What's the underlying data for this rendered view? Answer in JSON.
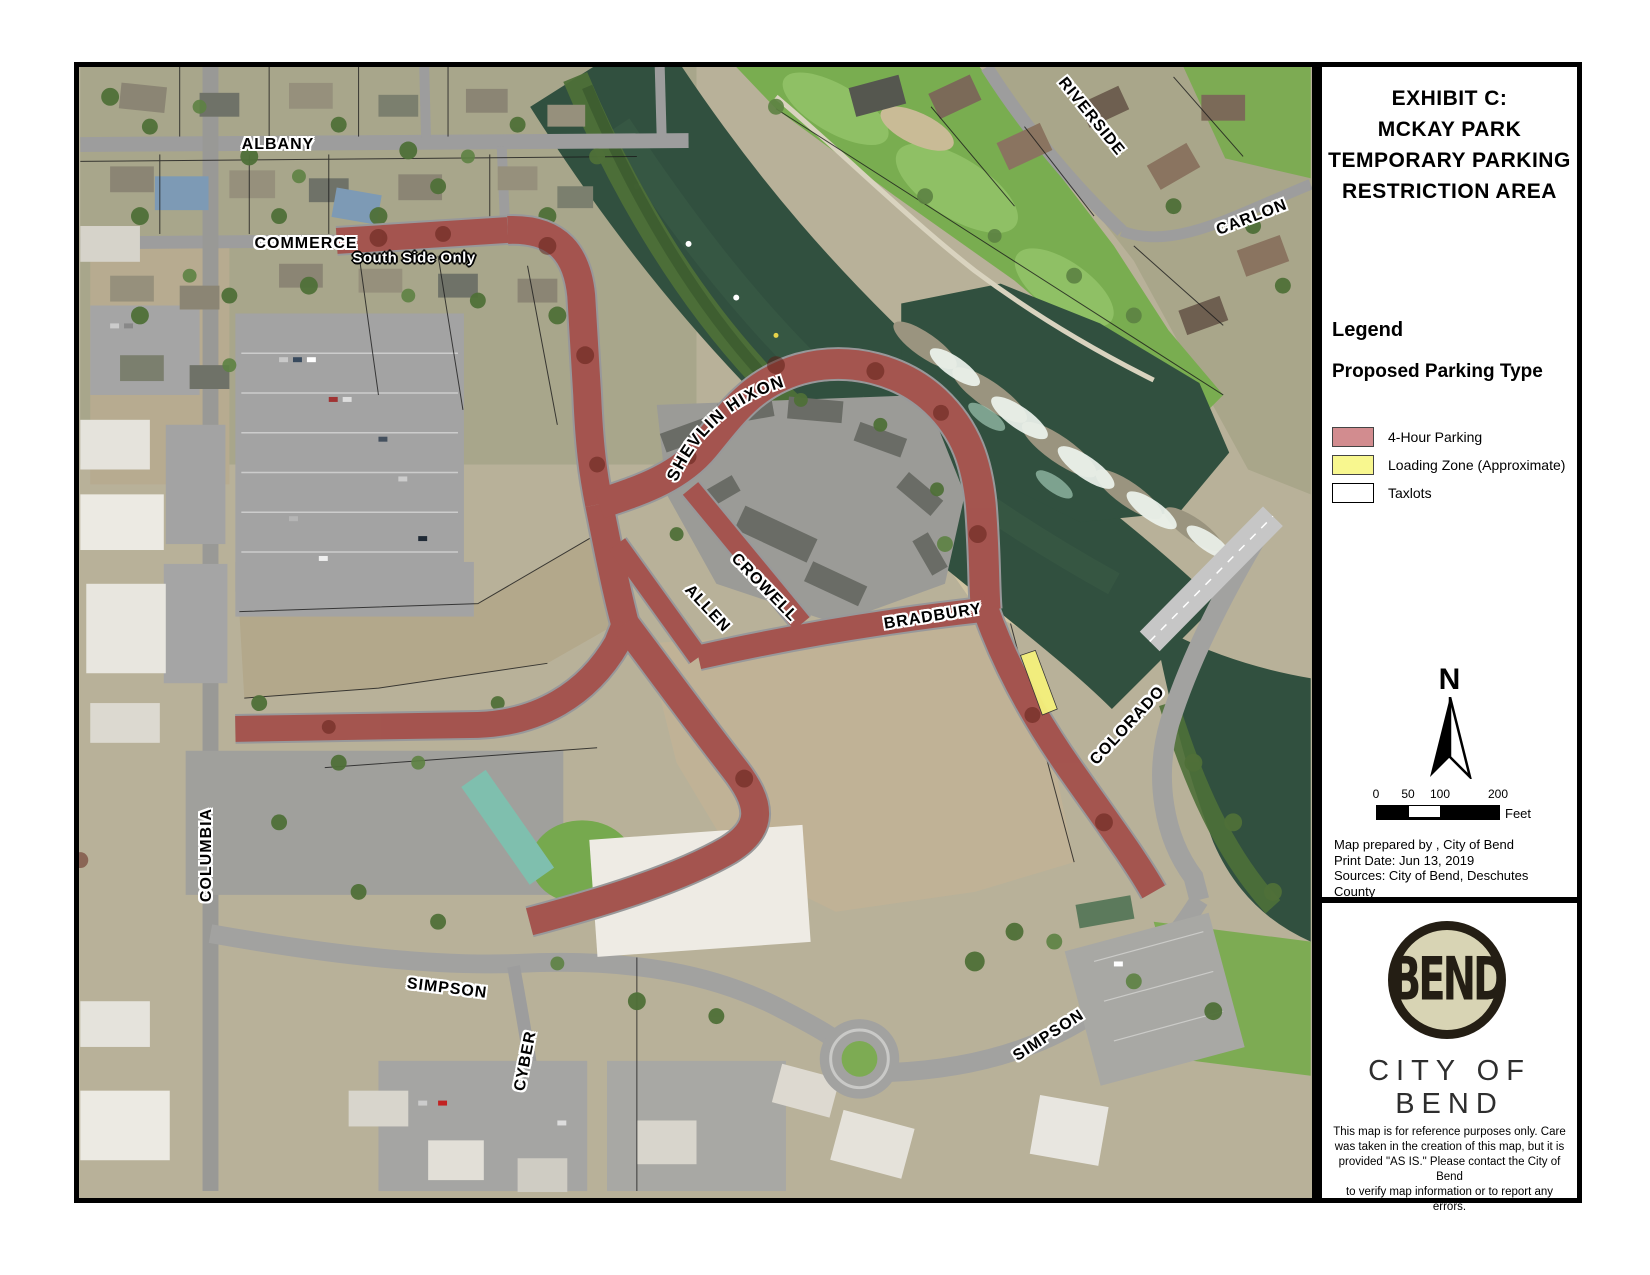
{
  "panel": {
    "title_lines": [
      "EXHIBIT C:",
      "MCKAY PARK",
      "TEMPORARY PARKING",
      "RESTRICTION AREA"
    ],
    "legend": {
      "heading": "Legend",
      "group_heading": "Proposed Parking Type",
      "items": [
        {
          "label": "4-Hour Parking",
          "color": "#d28c8f"
        },
        {
          "label": "Loading Zone (Approximate)",
          "color": "#f8f78f"
        },
        {
          "label": "Taxlots",
          "color": "#ffffff"
        }
      ]
    },
    "north_arrow_label": "N",
    "scale_bar": {
      "ticks": [
        "0",
        "50",
        "100",
        "200"
      ],
      "unit": "Feet"
    },
    "credits_lines": [
      "Map prepared by ,  City of Bend",
      "Print Date: Jun 13, 2019",
      "Sources: City of Bend, Deschutes County"
    ],
    "logo": {
      "monogram": "BEND",
      "city_name": "CITY OF BEND"
    },
    "disclaimer_lines": [
      "This map is for reference purposes only.  Care",
      "was taken in the creation of this map, but it is",
      "provided \"AS IS.\" Please contact the City of Bend",
      "to verify map information or to report any errors."
    ]
  },
  "map": {
    "street_labels": [
      {
        "id": "albany",
        "text": "ALBANY"
      },
      {
        "id": "commerce",
        "text": "COMMERCE"
      },
      {
        "id": "south-side-only",
        "text": "South Side Only"
      },
      {
        "id": "riverside",
        "text": "RIVERSIDE"
      },
      {
        "id": "carlon",
        "text": "CARLON"
      },
      {
        "id": "shevlin-hixon",
        "text": "SHEVLIN HIXON"
      },
      {
        "id": "crowell",
        "text": "CROWELL"
      },
      {
        "id": "allen",
        "text": "ALLEN"
      },
      {
        "id": "bradbury",
        "text": "BRADBURY"
      },
      {
        "id": "colorado",
        "text": "COLORADO"
      },
      {
        "id": "columbia",
        "text": "COLUMBIA"
      },
      {
        "id": "simpson-west",
        "text": "SIMPSON"
      },
      {
        "id": "simpson-east",
        "text": "SIMPSON"
      },
      {
        "id": "cyber",
        "text": "CYBER"
      }
    ],
    "overlay_colors": {
      "four_hour_parking": "#a8423a",
      "loading_zone": "#f5f17c"
    }
  }
}
